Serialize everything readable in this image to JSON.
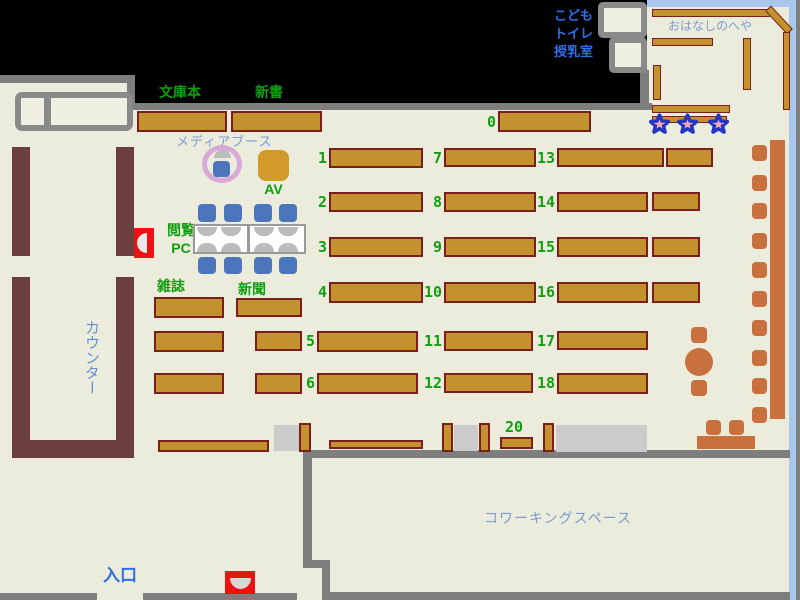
{
  "map": {
    "title": "library-floor-map",
    "labels": {
      "paperback": "文庫本",
      "new_books": "新書",
      "media_booth": "メディアブース",
      "av": "AV",
      "pc_line1": "閲覧",
      "pc_line2": "PC",
      "magazines": "雑誌",
      "newspapers": "新聞",
      "counter": "カウンター",
      "entrance": "入口",
      "coworking": "コワーキングスペース",
      "kids": "こども",
      "toilet": "トイレ",
      "nursing_room": "授乳室",
      "story_room": "おはなしのへや"
    },
    "shelf_numbers": [
      "0",
      "1",
      "2",
      "3",
      "4",
      "5",
      "6",
      "7",
      "8",
      "9",
      "10",
      "11",
      "12",
      "13",
      "14",
      "15",
      "16",
      "17",
      "18",
      "20"
    ]
  },
  "colors": {
    "background": "#000000",
    "floor": "#ECECDD",
    "wall_gray": "#7E7E7E",
    "room_wall_gray": "#8A8A8A",
    "shelf_fill": "#C4912F",
    "shelf_border": "#7A1E1E",
    "counter_maroon": "#6C3F3F",
    "blue_wall": "#A9C7EC",
    "label_green": "#0F9F0F",
    "label_blue": "#2E6FE8",
    "label_light_blue": "#7C9CD0",
    "chair_blue": "#4B76BB",
    "stool_terracotta": "#C8713F",
    "marker_red": "#EE1111",
    "copier_gray": "#CBCBCB",
    "star_outline_blue": "#2236C4",
    "star_fill_red": "#D84040",
    "star_center_pink": "#F7A8B0",
    "media_ring_pink": "#D8A8D8"
  }
}
